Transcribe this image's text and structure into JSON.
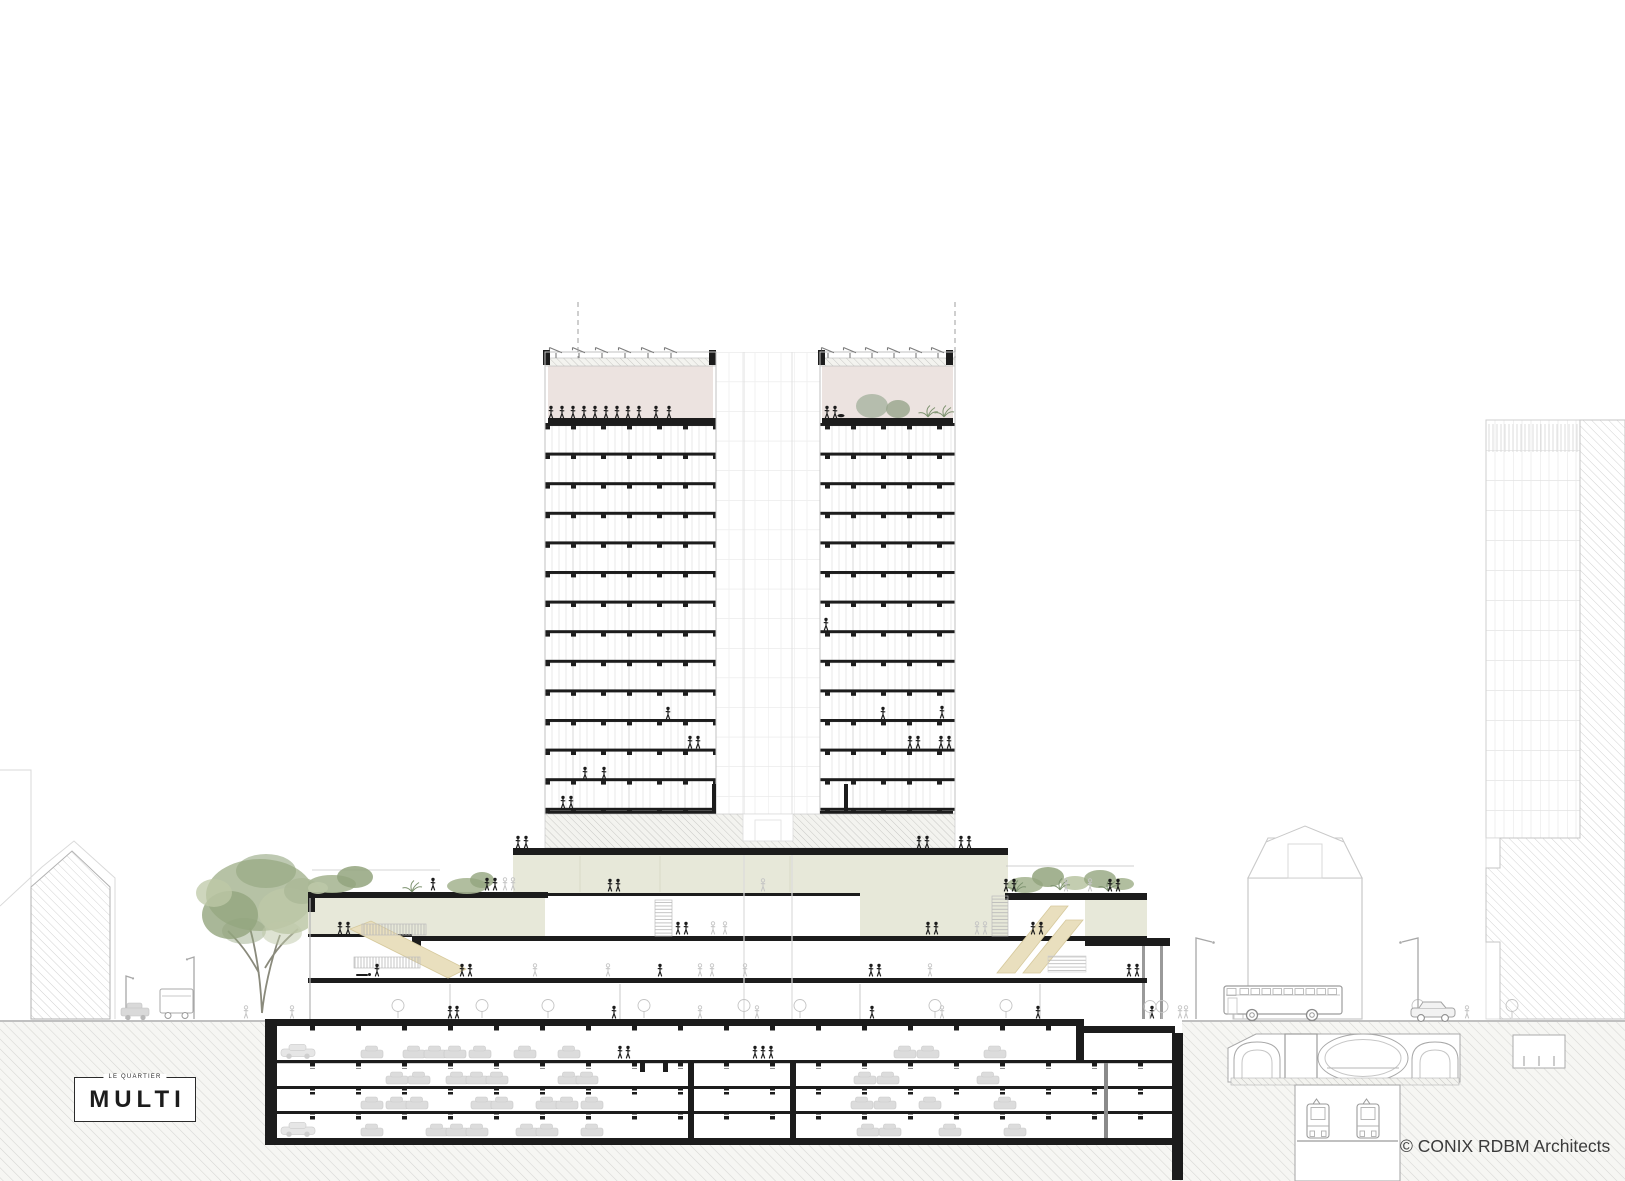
{
  "logo": {
    "prefix": "LE QUARTIER",
    "name": "MULTI"
  },
  "credit": {
    "text": "© CONIX RDBM Architects"
  },
  "colors": {
    "paper": "#ffffff",
    "ink": "#1c1c1c",
    "line": "#b9b9b9",
    "line-faint": "#e3e3e3",
    "hatch": "#cfcfce",
    "earth-bg": "#f7f7f4",
    "green": "#e7e8d9",
    "green-line": "#ccceba",
    "pink": "#ece3e0",
    "beige": "#e9dfbe",
    "beige-line": "#d6c99c",
    "car": "#dcdcdc",
    "tree1": "#93a57e",
    "tree2": "#a9b795",
    "tree3": "#bdc8a7",
    "fern": "#7e9370",
    "ghost": "#c4c4c4",
    "credit": "#3a3a3a"
  },
  "structure": {
    "tower_floors_visible": 14,
    "tower_wings": 2,
    "podium_levels_above_ground": 3,
    "basement_parking_levels": 4,
    "metro_station_tunnels": 3,
    "metro_trains_visible": 2,
    "rooftop_solar_panel_rows": 2
  }
}
